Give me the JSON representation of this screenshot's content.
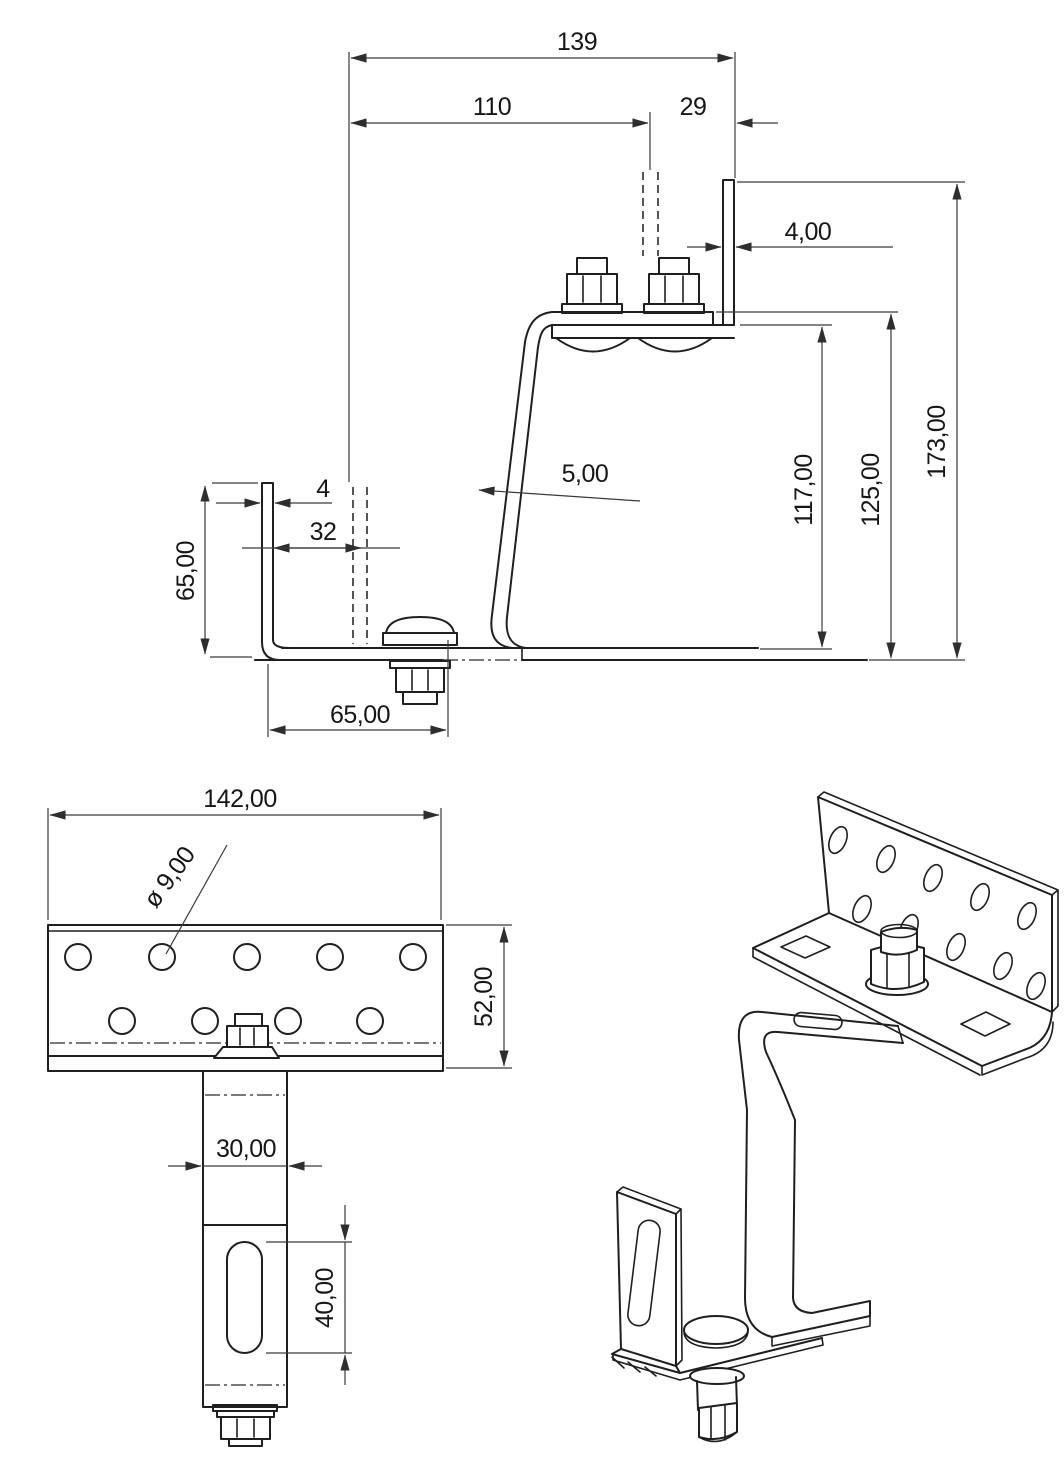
{
  "side_view": {
    "width_total": "139",
    "width_left": "110",
    "width_right": "29",
    "top_flange_thickness": "4,00",
    "height_inner": "117,00",
    "height_mid": "125,00",
    "height_total": "173,00",
    "hook_thickness": "5,00",
    "left_flange_height": "65,00",
    "left_flange_thickness": "4",
    "left_offset": "32",
    "base_bolt_offset": "65,00"
  },
  "front_view": {
    "plate_width": "142,00",
    "hole_diameter": "ø 9,00",
    "plate_height": "52,00",
    "column_width": "30,00",
    "slot_length": "40,00"
  }
}
